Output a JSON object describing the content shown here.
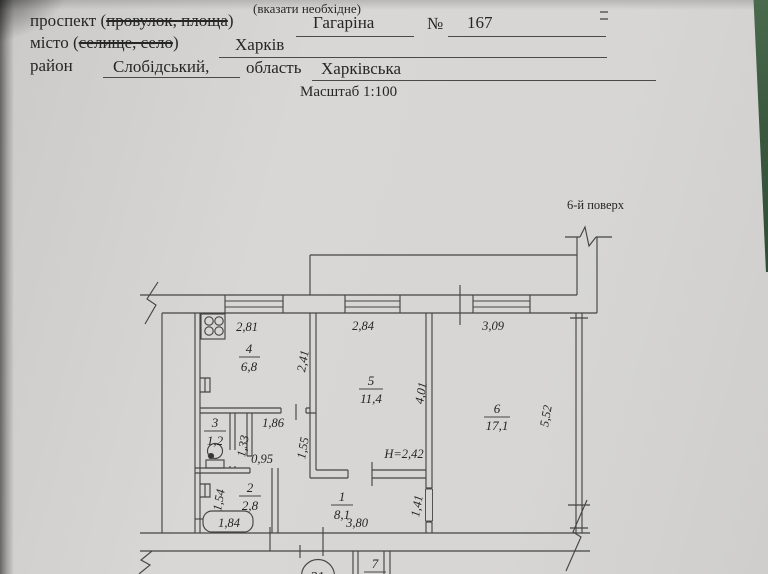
{
  "header": {
    "hint": "(вказати необхідне)",
    "row1": {
      "label": "проспект",
      "paren_open": "(",
      "struck": "провулок, площа",
      "paren_close": ")",
      "value": "Гагаріна",
      "no_sign": "№",
      "number": "167"
    },
    "row2": {
      "label": "місто",
      "paren_open": "(",
      "struck": "селище, село",
      "paren_close": ")",
      "value": "Харків"
    },
    "row3": {
      "label": "район",
      "value": "Слобідський,",
      "label2": "область",
      "value2": "Харківська"
    },
    "scale": "Масштаб 1:100"
  },
  "plan": {
    "floor": "6-й поверх",
    "apt": "21",
    "rooms": {
      "r4": {
        "num": "4",
        "area": "6,8"
      },
      "r5": {
        "num": "5",
        "area": "11,4"
      },
      "r6": {
        "num": "6",
        "area": "17,1"
      },
      "r3": {
        "num": "3",
        "area": "1,2"
      },
      "r2": {
        "num": "2",
        "area": "2,8"
      },
      "r1": {
        "num": "1",
        "area": "8,1"
      },
      "r7": {
        "num": "7",
        "area": ""
      }
    },
    "dims": {
      "k_w": "2,81",
      "r5_w": "2,84",
      "r6_w": "3,09",
      "k_d": "2,41",
      "r5_d": "4,01",
      "r6_d": "5,52",
      "cor_w": "1,86",
      "shaft": "1,33",
      "cor_d": "1,55",
      "pass": "0,95",
      "bath_d": "1,54",
      "tub": "1,84",
      "hall_w": "3,80",
      "door": "1,41",
      "height": "H=2,42"
    }
  }
}
